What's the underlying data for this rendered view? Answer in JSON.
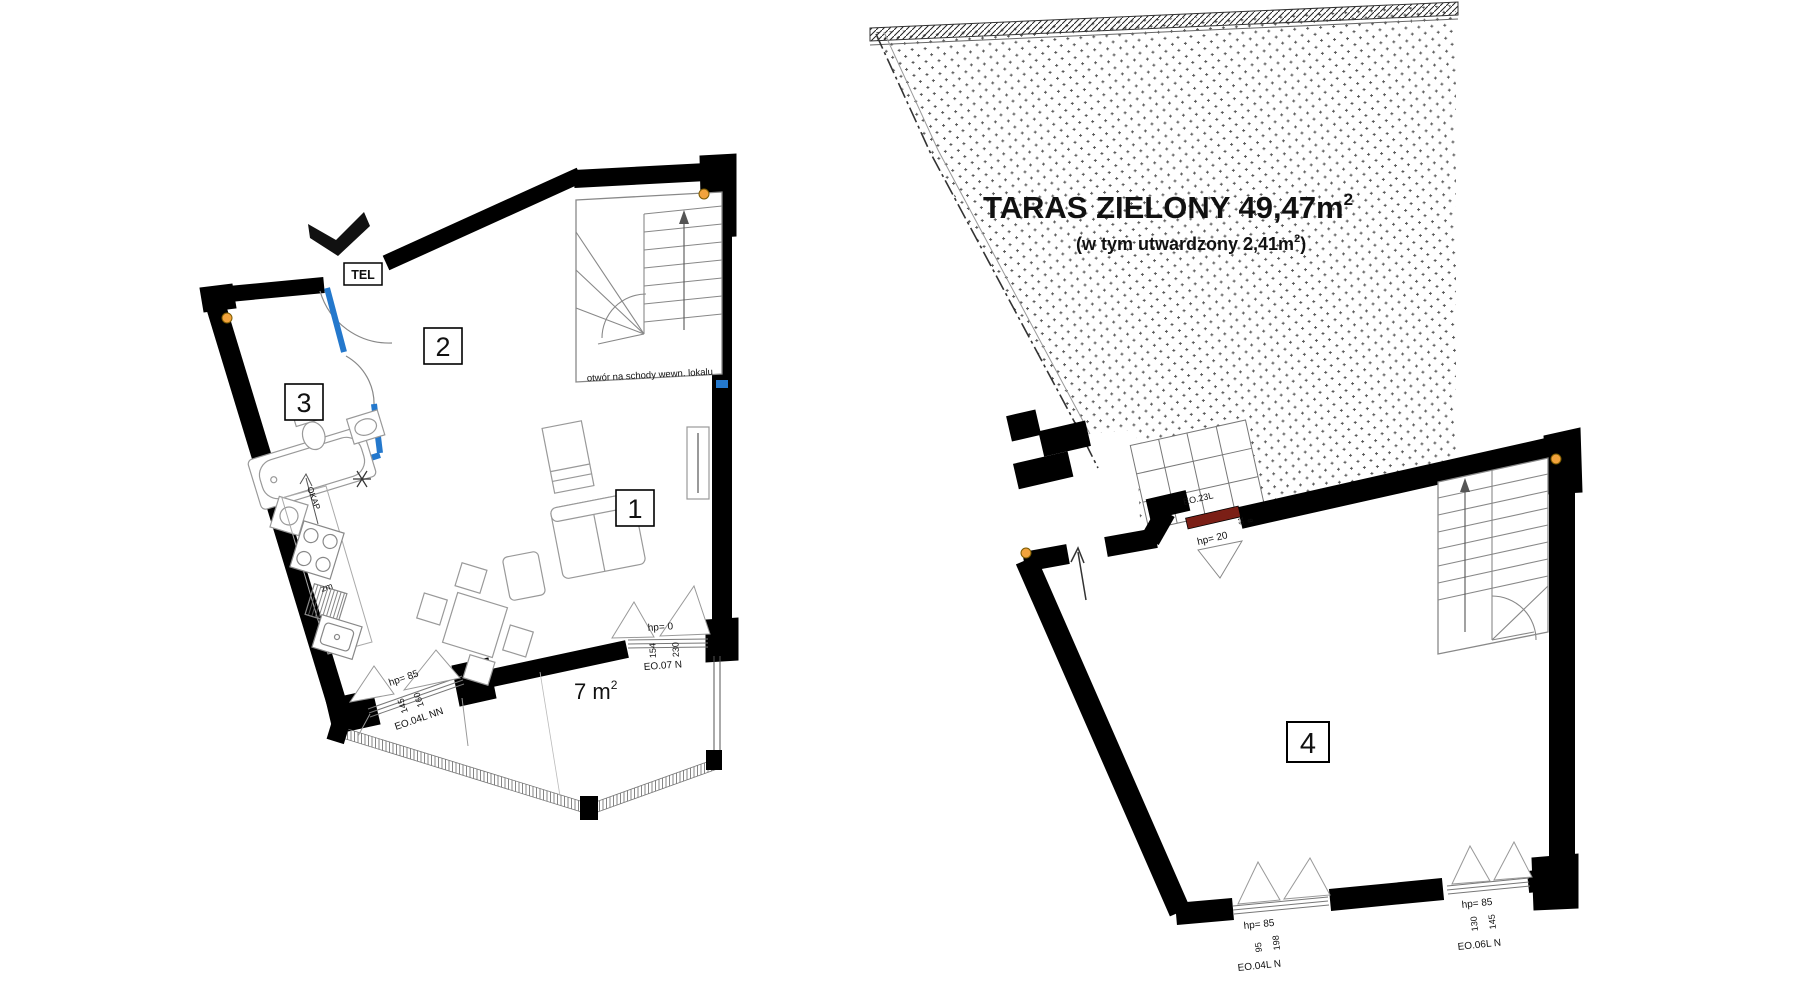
{
  "colors": {
    "wall": "#000000",
    "partition_blue": "#2478cc",
    "sill_red": "#7b1f16",
    "marker_orange": "#f2a33c",
    "line_gray": "#8a8a8a"
  },
  "left_plan": {
    "rooms": [
      {
        "label": "1"
      },
      {
        "label": "2"
      },
      {
        "label": "3"
      }
    ],
    "tel_label": "TEL",
    "stairs_note": "otwór na schody wewn. lokalu",
    "balcony_area_value": "7 m",
    "balcony_area_sup": "2",
    "kitchen": {
      "hood_label": "OKAP",
      "dishwasher_label": "zm"
    },
    "windows": [
      {
        "id": "EO.04L NN",
        "hp": "hp= 85",
        "dim_a": "145",
        "dim_b": "160"
      },
      {
        "id": "EO.07 N",
        "hp": "hp= 0",
        "dim_a": "154",
        "dim_b": "230"
      }
    ]
  },
  "right_plan": {
    "terrace": {
      "title": "TARAS ZIELONY 49,47m",
      "title_sup": "2",
      "subtitle_pre": "(w tym utwardzony 2,41m",
      "subtitle_sup": "2",
      "subtitle_post": ")"
    },
    "room_label": "4",
    "windows": [
      {
        "id": "EO.23L",
        "hp": "hp= 20",
        "dim_a": "61",
        "dim_b": "8"
      },
      {
        "id": "EO.04L N",
        "hp": "hp= 85",
        "dim_a": "95",
        "dim_b": "198"
      },
      {
        "id": "EO.06L N",
        "hp": "hp= 85",
        "dim_a": "130",
        "dim_b": "145"
      }
    ]
  }
}
